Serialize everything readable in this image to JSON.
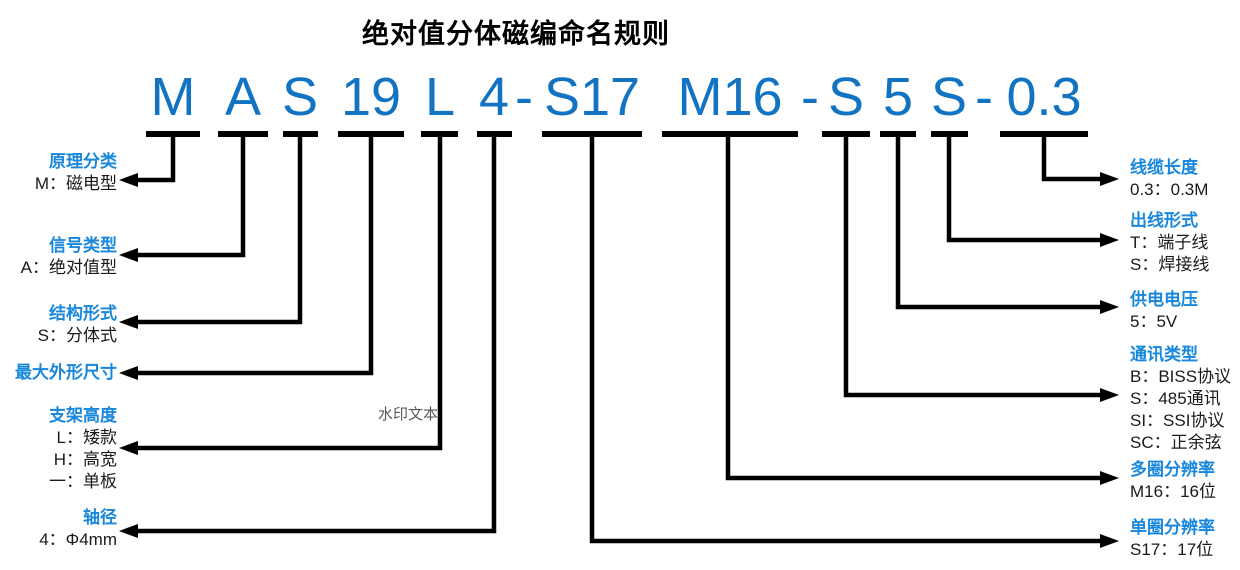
{
  "title": "绝对值分体磁编命名规则",
  "watermark": "水印文本",
  "colors": {
    "code_blue": "#1173C2",
    "label_blue": "#1887DC",
    "line_black": "#000000"
  },
  "code": {
    "full": "M A S 19 L 4-S17 M16-S 5 S-0.3",
    "tokens": [
      "M",
      "A",
      "S",
      "19",
      "L",
      "4",
      "-",
      "S17",
      "M16",
      "-",
      "S",
      "5",
      "S",
      "-",
      "0.3"
    ]
  },
  "left_labels": [
    {
      "title": "原理分类",
      "values": [
        "M：磁电型"
      ]
    },
    {
      "title": "信号类型",
      "values": [
        "A：绝对值型"
      ]
    },
    {
      "title": "结构形式",
      "values": [
        "S：分体式"
      ]
    },
    {
      "title": "最大外形尺寸",
      "values": []
    },
    {
      "title": "支架高度",
      "values": [
        "L：矮款",
        "H：高宽",
        "一：单板"
      ]
    },
    {
      "title": "轴径",
      "values": [
        "4：Φ4mm"
      ]
    }
  ],
  "right_labels": [
    {
      "title": "线缆长度",
      "values": [
        "0.3：0.3M"
      ]
    },
    {
      "title": "出线形式",
      "values": [
        "T：端子线",
        "S：焊接线"
      ]
    },
    {
      "title": "供电电压",
      "values": [
        "5：5V"
      ]
    },
    {
      "title": "通讯类型",
      "values": [
        "B：BISS协议",
        "S：485通讯",
        "SI：SSI协议",
        "SC：正余弦"
      ]
    },
    {
      "title": "多圈分辨率",
      "values": [
        "M16：16位"
      ]
    },
    {
      "title": "单圈分辨率",
      "values": [
        "S17：17位"
      ]
    }
  ]
}
